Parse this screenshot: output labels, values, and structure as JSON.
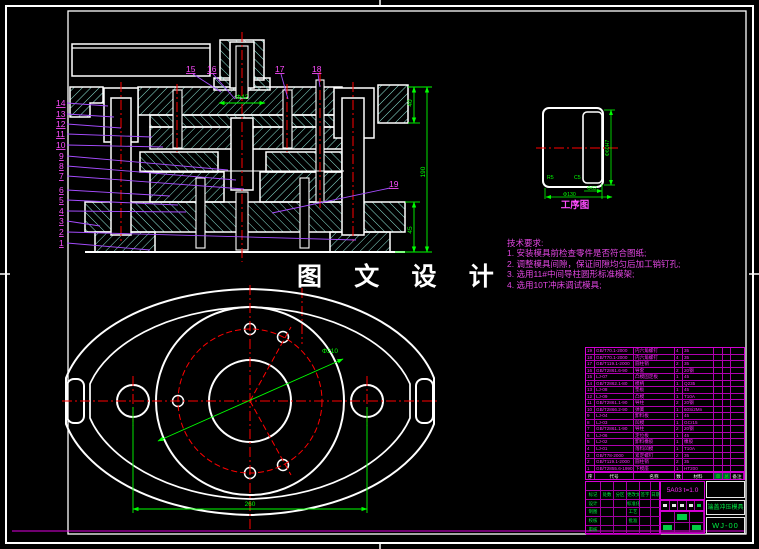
{
  "sheet": {
    "watermark": "图 文 设 计",
    "process_label": "工序图"
  },
  "notes": {
    "title": "技术要求:",
    "lines": [
      "1.  安装模具前检查零件是否符合图纸;",
      "2.  调整模具间隙，保证间隙均匀后加工销钉孔;",
      "3.  选用11#中间导柱圆形标准模架;",
      "4.  选用10T冲床调试模具;"
    ]
  },
  "section_dims": {
    "punch_dia": "Φ42",
    "top": "40",
    "overall": "190",
    "bottom": "45"
  },
  "flange_dims": {
    "bolt_circle": "Φ210",
    "span": "260"
  },
  "process_dims": {
    "height": "Φ60H7",
    "inner": "Φ62",
    "outer": "Φ130",
    "r_label": "R5",
    "c_label": "C5"
  },
  "callouts": {
    "left": [
      "14",
      "13",
      "12",
      "11",
      "10",
      "9",
      "8",
      "7",
      "6",
      "5",
      "4",
      "3",
      "2",
      "1"
    ],
    "top": [
      "15",
      "16",
      "17",
      "18"
    ],
    "right": "19"
  },
  "bom": {
    "headers": [
      "序号",
      "代号",
      "名称",
      "数量",
      "材料",
      "单件",
      "总计",
      "备注"
    ],
    "rows": [
      [
        "19",
        "GB/T70.1-2000",
        "内六角螺钉",
        "4",
        "35",
        "",
        "",
        ""
      ],
      [
        "18",
        "GB/T70.1-2000",
        "内六角螺钉",
        "4",
        "35",
        "",
        "",
        ""
      ],
      [
        "17",
        "GB/T119.1-2000",
        "圆柱销",
        "2",
        "35",
        "",
        "",
        ""
      ],
      [
        "16",
        "GB/T2861.6-90",
        "导套",
        "2",
        "20钢",
        "",
        "",
        ""
      ],
      [
        "15",
        "LJ-07",
        "凸模固定板",
        "1",
        "45",
        "",
        "",
        ""
      ],
      [
        "14",
        "GB/T2862.1-80",
        "模柄",
        "1",
        "Q235",
        "",
        "",
        ""
      ],
      [
        "13",
        "LJ-08",
        "垫板",
        "1",
        "45",
        "",
        "",
        ""
      ],
      [
        "12",
        "LJ-09",
        "凸模",
        "1",
        "T10A",
        "",
        "",
        ""
      ],
      [
        "11",
        "GB/T2861.1-90",
        "导柱",
        "2",
        "20钢",
        "",
        "",
        ""
      ],
      [
        "10",
        "GB/T2866.2-90",
        "弹簧",
        "1",
        "60Si2Mn",
        "",
        "",
        ""
      ],
      [
        "9",
        "LJ-04",
        "卸料板",
        "1",
        "45",
        "",
        "",
        ""
      ],
      [
        "8",
        "LJ-03",
        "凹模",
        "1",
        "GCr15",
        "",
        "",
        ""
      ],
      [
        "7",
        "GB/T2861.1-90",
        "导柱",
        "2",
        "20钢",
        "",
        "",
        ""
      ],
      [
        "6",
        "LJ-06",
        "定位板",
        "1",
        "45",
        "",
        "",
        ""
      ],
      [
        "5",
        "LJ-02",
        "卸料橡胶",
        "1",
        "橡胶",
        "",
        "",
        ""
      ],
      [
        "4",
        "LJ-01",
        "落料凹模",
        "1",
        "T10A",
        "",
        "",
        ""
      ],
      [
        "3",
        "GB/T78-2000",
        "紧定螺钉",
        "2",
        "35",
        "",
        "",
        ""
      ],
      [
        "2",
        "GB/T119.1-2000",
        "圆柱销",
        "2",
        "35",
        "",
        "",
        ""
      ],
      [
        "1",
        "GB/T2855.6-1990",
        "下模座",
        "1",
        "HT200",
        "",
        "",
        ""
      ]
    ]
  },
  "title_block": {
    "material": "5A03  t=1.0",
    "title": "端盖冲压模具",
    "drawing_no": "WJ-00",
    "sign_grid": [
      [
        "",
        "",
        "",
        "",
        "",
        ""
      ],
      [
        "标记",
        "处数",
        "分区",
        "更改文件",
        "签字",
        "日期"
      ],
      [
        "设计",
        "",
        "",
        "标准化",
        "",
        ""
      ],
      [
        "制图",
        "",
        "",
        "工艺",
        "",
        ""
      ],
      [
        "校核",
        "",
        "",
        "批准",
        "",
        ""
      ],
      [
        "审核",
        "",
        "",
        "",
        "",
        ""
      ]
    ]
  }
}
